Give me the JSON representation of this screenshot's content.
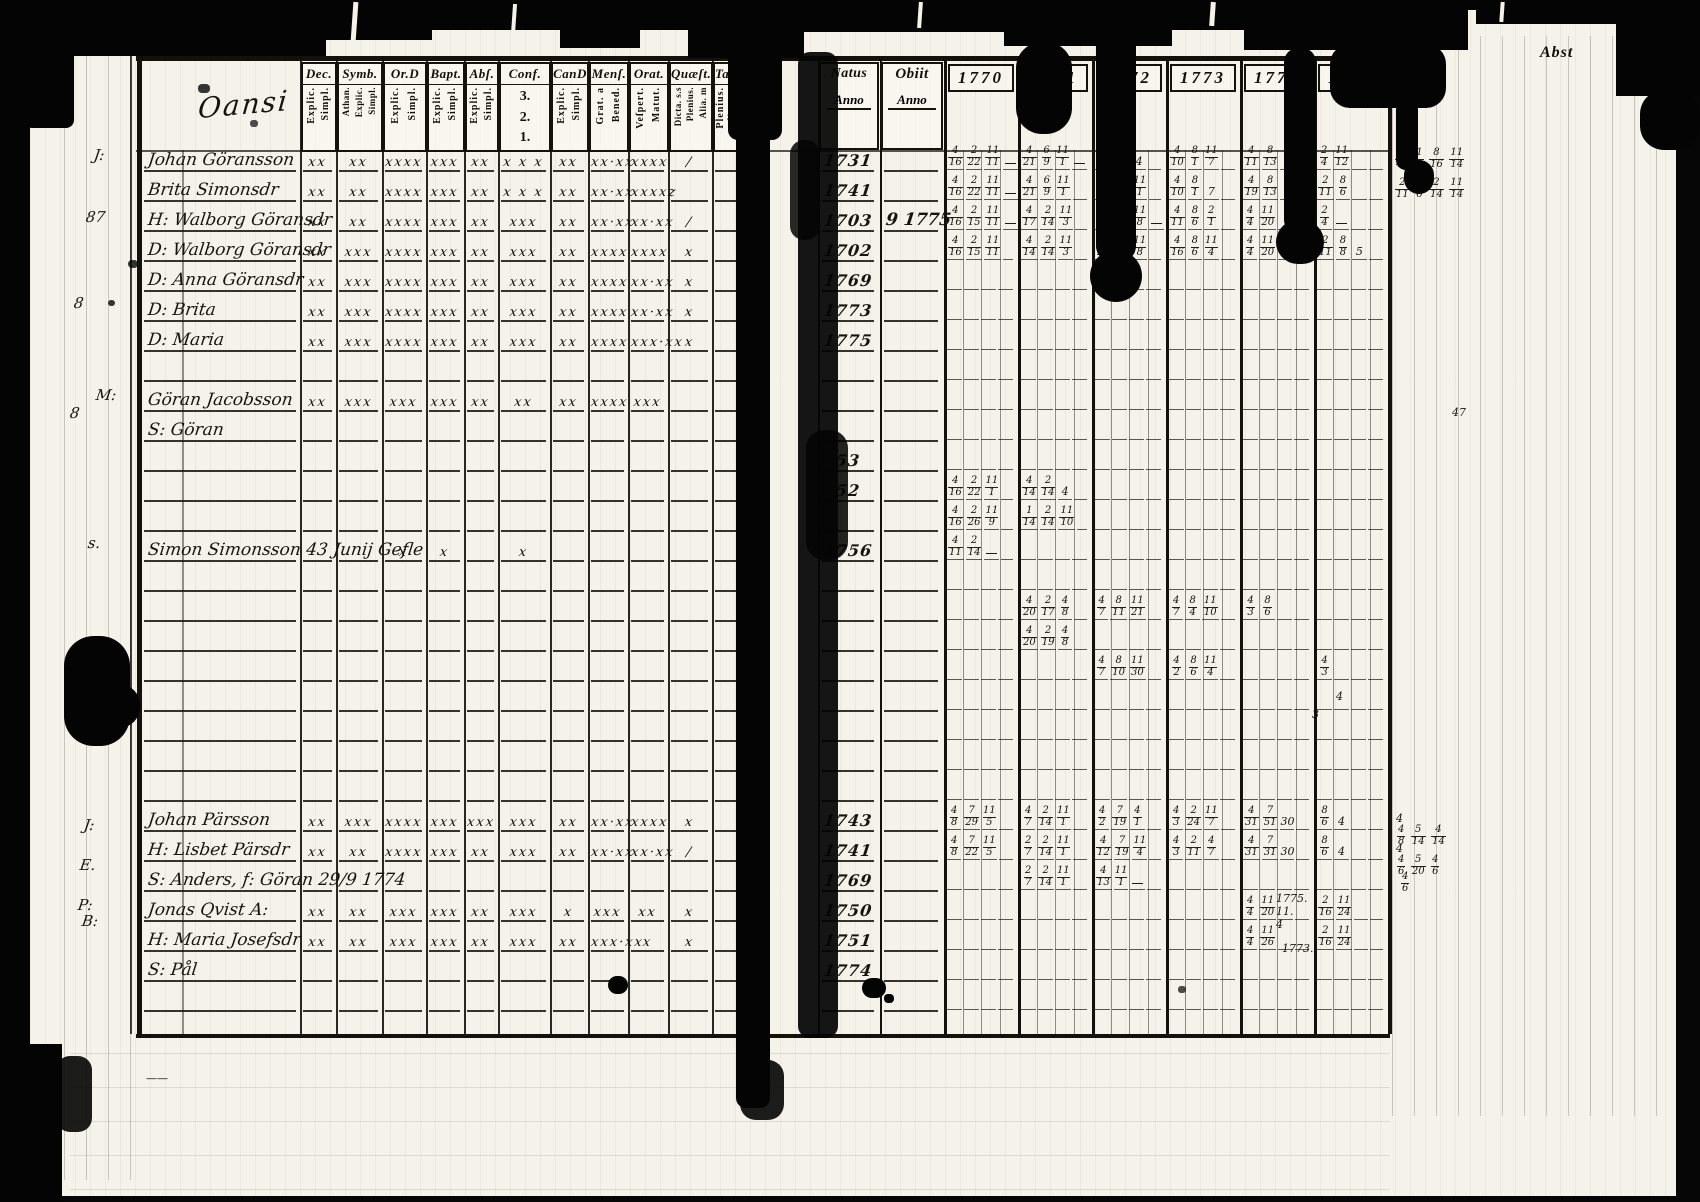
{
  "page": {
    "heading_script": "Oansi",
    "corner_label": "Abst",
    "description": "Scanned 18th-century Swedish parish communion examination register, spread with years 1770-1775"
  },
  "header": {
    "columns": [
      {
        "id": "name",
        "label": "",
        "subs": []
      },
      {
        "id": "dec",
        "label": "Dec.",
        "subs": [
          "Explic.",
          "Simpl."
        ]
      },
      {
        "id": "symb",
        "label": "Symb.",
        "subs": [
          "Athan.",
          "Explic.",
          "Simpl."
        ]
      },
      {
        "id": "ord",
        "label": "Or.D",
        "subs": [
          "Explic.",
          "Simpl."
        ]
      },
      {
        "id": "bapt",
        "label": "Bapt.",
        "subs": [
          "Explic.",
          "Simpl."
        ]
      },
      {
        "id": "abs",
        "label": "Abſ.",
        "subs": [
          "Explic.",
          "Simpl."
        ]
      },
      {
        "id": "conf",
        "label": "Conf.",
        "subs": [
          "3.",
          "2.",
          "1."
        ],
        "stacked": true
      },
      {
        "id": "cand",
        "label": "CanD",
        "subs": [
          "Explic.",
          "Simpl."
        ]
      },
      {
        "id": "mens",
        "label": "Menſ.",
        "subs": [
          "Grat. a",
          "Bened."
        ]
      },
      {
        "id": "orat",
        "label": "Orat.",
        "subs": [
          "Veſpert.",
          "Matut."
        ]
      },
      {
        "id": "quaest",
        "label": "Quæſt.",
        "subs": [
          "Dicta. s.s",
          "Plenius.",
          "Alia. m"
        ]
      },
      {
        "id": "tab",
        "label": "Tab.",
        "subs": [
          "Plenius.",
          "Alia. m."
        ]
      }
    ],
    "natus": {
      "label": "Natus",
      "sub": "Anno"
    },
    "obiit": {
      "label": "Obiit",
      "sub": "Anno"
    },
    "years": [
      "1770",
      "1771",
      "1772",
      "1773",
      "1774",
      "1775"
    ]
  },
  "rows": [
    {
      "i": 0,
      "name": "Johan Göransson",
      "marks": [
        "xx",
        "xx",
        "xxxx",
        "xxx",
        "xx",
        "x x x",
        "xx",
        "xx·xx",
        "xxxx",
        "/",
        ""
      ],
      "natus": "1731",
      "obiit": "",
      "years": [
        "4/16 2/22 11/11 —",
        "4/21 6/9 11/1 —",
        "4/20 7/26 4",
        "4/10 8/1 11/7",
        "4/11 8/13",
        "2/4 11/12"
      ]
    },
    {
      "i": 1,
      "name": "Brita Simonsdr",
      "marks": [
        "xx",
        "xx",
        "xxxx",
        "xxx",
        "xx",
        "x x x",
        "xx",
        "xx·xx",
        "xxxxz",
        "",
        ""
      ],
      "natus": "1741",
      "obiit": "",
      "years": [
        "4/16 2/22 11/11 —",
        "4/21 6/9 11/1",
        "4/10 8/22 11/1",
        "4/10 8/1 7",
        "4/19 8/13",
        "2/11 8/6"
      ]
    },
    {
      "i": 2,
      "name": "H: Walborg Göransdr",
      "marks": [
        "xx",
        "xx",
        "xxxx",
        "xxx",
        "xx",
        "xxx",
        "xx",
        "xx·xx",
        "xx·xx",
        "/",
        ""
      ],
      "natus": "1703",
      "obiit": "9 1775",
      "years": [
        "4/16 2/15 11/11 —",
        "4/17 2/14 11/3",
        "4/22 7/19 11/8 —",
        "4/11 8/6 2/1",
        "4/4 11/20",
        "2/4 —"
      ]
    },
    {
      "i": 3,
      "name": "D: Walborg Göransdr",
      "marks": [
        "xx",
        "xxx",
        "xxxx",
        "xxx",
        "xx",
        "xxx",
        "xx",
        "xxxx",
        "xxxx",
        "x",
        ""
      ],
      "natus": "1702",
      "obiit": "",
      "years": [
        "4/16 2/15 11/11",
        "4/14 2/14 11/3",
        "4/22 7/19 11/8",
        "4/16 8/6 11/4",
        "4/4 11/20",
        "2/11 8/8 5"
      ]
    },
    {
      "i": 4,
      "name": "D: Anna Göransdr",
      "marks": [
        "xx",
        "xxx",
        "xxxx",
        "xxx",
        "xx",
        "xxx",
        "xx",
        "xxxx",
        "xx·xx",
        "x",
        ""
      ],
      "natus": "1769",
      "obiit": "",
      "years": [
        "",
        "",
        "",
        "",
        "",
        ""
      ]
    },
    {
      "i": 5,
      "name": "D: Brita",
      "marks": [
        "xx",
        "xxx",
        "xxxx",
        "xxx",
        "xx",
        "xxx",
        "xx",
        "xxxx",
        "xx·xx",
        "x",
        ""
      ],
      "natus": "1773",
      "obiit": "",
      "years": [
        "",
        "",
        "",
        "",
        "",
        ""
      ]
    },
    {
      "i": 6,
      "name": "D: Maria",
      "marks": [
        "xx",
        "xxx",
        "xxxx",
        "xxx",
        "xx",
        "xxx",
        "xx",
        "xxxx",
        "xxx·xx",
        "x",
        ""
      ],
      "natus": "1775",
      "obiit": "",
      "years": [
        "",
        "",
        "",
        "",
        "",
        ""
      ]
    },
    {
      "i": 8,
      "name": "Göran Jacobsson",
      "marks": [
        "xx",
        "xxx",
        "xxx",
        "xxx",
        "xx",
        "xx",
        "xx",
        "xxxx",
        "xxx",
        "",
        ""
      ],
      "natus": "",
      "obiit": "",
      "years": [
        "",
        "",
        "",
        "",
        "",
        ""
      ]
    },
    {
      "i": 9,
      "name": "S: Göran",
      "marks": [
        "",
        "",
        "",
        "",
        "",
        "",
        "",
        "",
        "",
        "",
        ""
      ],
      "natus": "",
      "obiit": "",
      "years": [
        "",
        "",
        "",
        "",
        "",
        ""
      ]
    },
    {
      "i": 10,
      "name": "",
      "marks": [
        "",
        "",
        "",
        "",
        "",
        "",
        "",
        "",
        "",
        "",
        ""
      ],
      "natus": "53",
      "obiit": "",
      "years": [
        "",
        "",
        "",
        "",
        "",
        ""
      ]
    },
    {
      "i": 11,
      "name": "",
      "marks": [
        "",
        "",
        "",
        "",
        "",
        "",
        "",
        "",
        "",
        "",
        ""
      ],
      "natus": "52",
      "obiit": "",
      "years": [
        "4/16 2/22 11/1",
        "4/14 2/14 4",
        "",
        "",
        "",
        ""
      ]
    },
    {
      "i": 12,
      "name": "",
      "marks": [
        "",
        "",
        "",
        "",
        "",
        "",
        "",
        "",
        "",
        "",
        ""
      ],
      "natus": "",
      "obiit": "",
      "years": [
        "4/16 2/26 11/9",
        "1/14 2/14 11/10",
        "",
        "",
        "",
        ""
      ]
    },
    {
      "i": 13,
      "name": "Simon Simonsson   43  Junij  Gefle",
      "marks": [
        "",
        "",
        "x",
        "x",
        "",
        "x",
        "",
        "",
        "",
        "",
        ""
      ],
      "natus": "1756",
      "obiit": "",
      "years": [
        "4/11 2/14 —",
        "",
        "",
        "",
        "",
        ""
      ]
    },
    {
      "i": 15,
      "name": "",
      "marks": [
        "",
        "",
        "",
        "",
        "",
        "",
        "",
        "",
        "",
        "",
        ""
      ],
      "natus": "",
      "obiit": "",
      "years": [
        "",
        "4/20 2/17 4/8",
        "4/7 8/11 11/21",
        "4/7 8/4 11/10",
        "4/3 8/6",
        ""
      ]
    },
    {
      "i": 16,
      "name": "",
      "marks": [
        "",
        "",
        "",
        "",
        "",
        "",
        "",
        "",
        "",
        "",
        ""
      ],
      "natus": "",
      "obiit": "",
      "years": [
        "",
        "4/20 2/19 4/8",
        "",
        "",
        "",
        ""
      ]
    },
    {
      "i": 17,
      "name": "",
      "marks": [
        "",
        "",
        "",
        "",
        "",
        "",
        "",
        "",
        "",
        "",
        ""
      ],
      "natus": "",
      "obiit": "",
      "years": [
        "",
        "",
        "4/7 8/10 11/30",
        "4/2 8/6 11/4",
        "",
        "4/3"
      ]
    },
    {
      "i": 22,
      "name": "Johan Pärsson",
      "marks": [
        "xx",
        "xxx",
        "xxxx",
        "xxx",
        "xxx",
        "xxx",
        "xx",
        "xx·xx",
        "xxxx",
        "x",
        ""
      ],
      "natus": "1743",
      "obiit": "",
      "years": [
        "4/8 7/29 11/5",
        "4/7 2/14 11/1",
        "4/2 7/19 4/1",
        "4/3 2/24 11/7",
        "4/31 7/51 30",
        "8/6 4"
      ]
    },
    {
      "i": 23,
      "name": "H: Lisbet Pärsdr",
      "marks": [
        "xx",
        "xx",
        "xxxx",
        "xxx",
        "xx",
        "xxx",
        "xx",
        "xx·xx",
        "xx·xx",
        "/",
        ""
      ],
      "natus": "1741",
      "obiit": "",
      "years": [
        "4/8 7/22 11/5",
        "2/7 2/14 11/1",
        "4/12 7/19 11/4",
        "4/3 2/11 4/7",
        "4/31 7/31 30",
        "8/6 4"
      ]
    },
    {
      "i": 24,
      "name": "S: Anders, f: Göran 29/9 1774",
      "marks": [
        "",
        "",
        "",
        "",
        "",
        "",
        "",
        "",
        "",
        "",
        ""
      ],
      "natus": "1769",
      "obiit": "",
      "years": [
        "",
        "2/7 2/14 11/1",
        "4/13 11/1 —",
        "",
        "",
        ""
      ]
    },
    {
      "i": 25,
      "name": "Jonas Qvist A:",
      "marks": [
        "xx",
        "xx",
        "xxx",
        "xxx",
        "xx",
        "xxx",
        "x",
        "xxx",
        "xx",
        "x",
        ""
      ],
      "natus": "1750",
      "obiit": "",
      "years": [
        "",
        "",
        "",
        "",
        "4/4 11/20",
        "2/16 11/24"
      ]
    },
    {
      "i": 26,
      "name": "H: Maria Josefsdr",
      "marks": [
        "xx",
        "xx",
        "xxx",
        "xxx",
        "xx",
        "xxx",
        "xx",
        "xxx·xx",
        "x",
        "x",
        ""
      ],
      "natus": "1751",
      "obiit": "",
      "years": [
        "",
        "",
        "",
        "",
        "4/4 11/26",
        "2/16 11/24"
      ]
    },
    {
      "i": 27,
      "name": "S: Pål",
      "marks": [
        "",
        "",
        "",
        "",
        "",
        "",
        "",
        "",
        "",
        "",
        ""
      ],
      "natus": "1774",
      "obiit": "",
      "years": [
        "",
        "",
        "",
        "",
        "",
        ""
      ]
    }
  ],
  "margin_notes": [
    {
      "x": 94,
      "y": 146,
      "t": "J:"
    },
    {
      "x": 86,
      "y": 208,
      "t": "87"
    },
    {
      "x": 74,
      "y": 294,
      "t": "8"
    },
    {
      "x": 96,
      "y": 386,
      "t": "M:"
    },
    {
      "x": 70,
      "y": 404,
      "t": "8"
    },
    {
      "x": 88,
      "y": 534,
      "t": "s."
    },
    {
      "x": 84,
      "y": 816,
      "t": "J:"
    },
    {
      "x": 80,
      "y": 856,
      "t": "E."
    },
    {
      "x": 78,
      "y": 896,
      "t": "P:"
    },
    {
      "x": 82,
      "y": 912,
      "t": "B:"
    }
  ],
  "stray_texts": [
    {
      "x": 1190,
      "y": 0,
      "t": "2",
      "s": 26
    },
    {
      "x": 1452,
      "y": 406,
      "t": "47",
      "s": 15
    },
    {
      "x": 1336,
      "y": 690,
      "t": "4",
      "s": 14
    },
    {
      "x": 1312,
      "y": 708,
      "t": "3",
      "s": 13
    },
    {
      "x": 1394,
      "y": 148,
      "t": "2/4 11/12 8/16 11/14",
      "s": 11
    },
    {
      "x": 1394,
      "y": 178,
      "t": "2/11 8/6 2/14 11/14",
      "s": 11
    },
    {
      "x": 1396,
      "y": 812,
      "t": "4 4/8 5/14 4/14",
      "s": 11
    },
    {
      "x": 1396,
      "y": 842,
      "t": "4 4/6 5/20 4/6",
      "s": 11
    },
    {
      "x": 1400,
      "y": 872,
      "t": "4/6",
      "s": 11
    },
    {
      "x": 1276,
      "y": 892,
      "t": "1775. 11. 4",
      "s": 13
    },
    {
      "x": 1282,
      "y": 942,
      "t": "1773.",
      "s": 13
    },
    {
      "x": 146,
      "y": 1072,
      "t": "——",
      "s": 14
    }
  ],
  "colors": {
    "paper": "#f5f2ea",
    "ink": "#17130e",
    "damage": "#040404"
  }
}
